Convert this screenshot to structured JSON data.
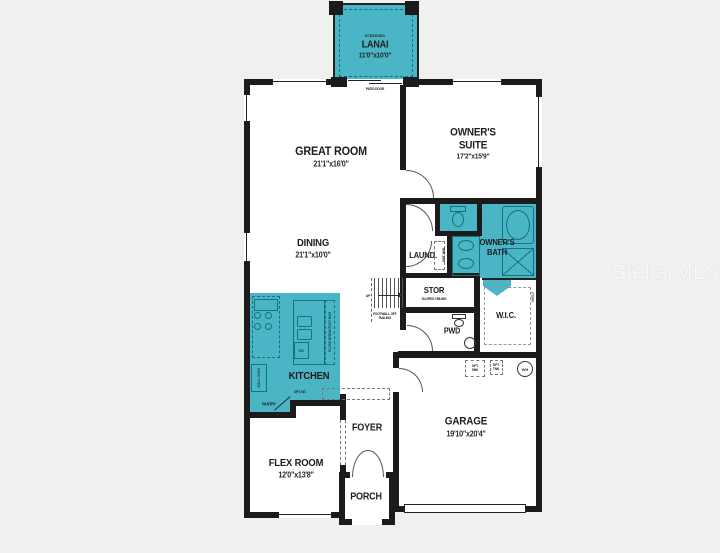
{
  "watermark": "StellarMLS",
  "colors": {
    "highlight": "#49b5c5",
    "highlight_dark": "#17717f",
    "wall": "#1b1b1b",
    "background": "#f0f0ef"
  },
  "rooms": {
    "lanai": {
      "tag": "SCREENED",
      "name": "LANAI",
      "dims": "11'0\"x10'0\""
    },
    "patio_door_label": "PATIO DOOR",
    "great_room": {
      "name": "GREAT ROOM",
      "dims": "21'1\"x16'0\""
    },
    "owners_suite": {
      "name": "OWNER'S SUITE",
      "dims": "17'2\"x15'9\""
    },
    "dining": {
      "name": "DINING",
      "dims": "21'1\"x10'0\""
    },
    "owners_bath": {
      "name": "OWNER'S BATH"
    },
    "laundry": {
      "name": "LAUND.",
      "note": "OPT. W/D"
    },
    "stor": {
      "name": "STOR",
      "note": "SLOPED CEILING"
    },
    "stairs": {
      "up": "UP",
      "note": "FOOTWALL OPT. RAILING"
    },
    "pwd": {
      "name": "PWD"
    },
    "wic": {
      "name": "W.I.C.",
      "note": "SHELF"
    },
    "kitchen": {
      "name": "KITCHEN",
      "island_note": "FLUSH BREAKFAST BAR",
      "dishwasher": "DW",
      "wall_oven": "WALL OVEN",
      "opt_note": "OPT. KIT.",
      "pantry": "PANTRY"
    },
    "flex_room": {
      "name": "FLEX ROOM",
      "dims": "12'0\"x13'8\""
    },
    "foyer": {
      "name": "FOYER"
    },
    "porch": {
      "name": "PORCH"
    },
    "garage": {
      "name": "GARAGE",
      "dims": "19'10\"x20'4\"",
      "opt_sink": "OPT. SNK",
      "opt_tank": "OPT. TNK",
      "water_heater": "WH"
    }
  }
}
